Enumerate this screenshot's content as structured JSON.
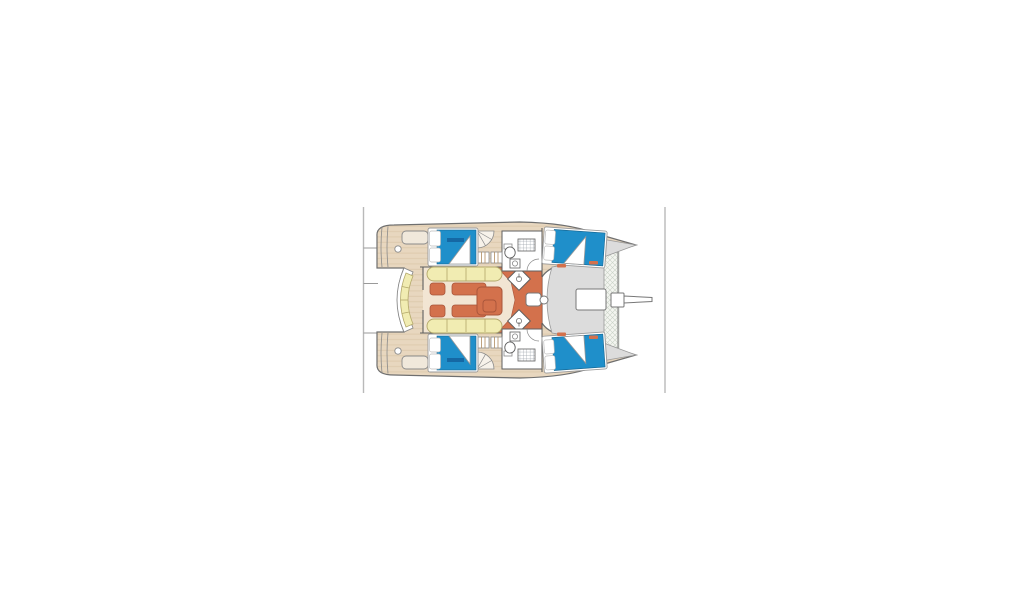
{
  "page": {
    "background": "#ffffff",
    "frame": {
      "left_rule_x": 363.5,
      "right_rule_x": 665,
      "rule_top_y": 207,
      "rule_bottom_y": 393,
      "rule_color": "#b9b9b9"
    }
  },
  "diagram": {
    "kind": "catamaran-interior-deck-plan",
    "view": "top-down layout plan, bow pointing right",
    "colors": {
      "outline": "#6f6f6f",
      "wall_gray": "#5f5f5f",
      "light_line": "#8a8a8a",
      "deck_wood": "#e8d7bf",
      "wood_grain": "#d4bf9f",
      "saloon_floor": "#f2e5d3",
      "galley_floor": "#d3714c",
      "furniture_orange": "#d3714c",
      "furniture_orange_dark": "#a8553a",
      "cushion_yellow": "#f1ecb2",
      "cushion_yellow_dark": "#b3a86a",
      "mattress_blue": "#1f8fca",
      "mattress_blue_dark": "#15648f",
      "bed_label_blue": "#1464a0",
      "coachroof_gray": "#dcdcdc",
      "trampoline_bg": "#f3f5f0",
      "trampoline_hatch": "#c9d1c6",
      "fixture_white": "#ffffff",
      "step_cream": "#f7f2ea"
    },
    "regions": [
      {
        "id": "cockpit",
        "label": "aft cockpit with curved bench seating"
      },
      {
        "id": "saloon",
        "label": "saloon with settees, chaises and table"
      },
      {
        "id": "galley",
        "label": "galley strip with twin diamond sinks"
      },
      {
        "id": "port-aft-cabin",
        "label": "double berth cabin"
      },
      {
        "id": "starboard-aft-cabin",
        "label": "double berth cabin"
      },
      {
        "id": "port-forward-cabin",
        "label": "double berth cabin"
      },
      {
        "id": "starboard-forward-cabin",
        "label": "double berth cabin"
      },
      {
        "id": "port-head",
        "label": "bathroom with shower, WC and basin"
      },
      {
        "id": "starboard-head",
        "label": "bathroom with shower, WC and basin"
      },
      {
        "id": "foredeck",
        "label": "coachroof front and anchor lockers"
      },
      {
        "id": "trampoline",
        "label": "bow trampoline net"
      },
      {
        "id": "bowsprit",
        "label": "bowsprit pole"
      }
    ],
    "berth_count": 4,
    "head_count": 2
  }
}
